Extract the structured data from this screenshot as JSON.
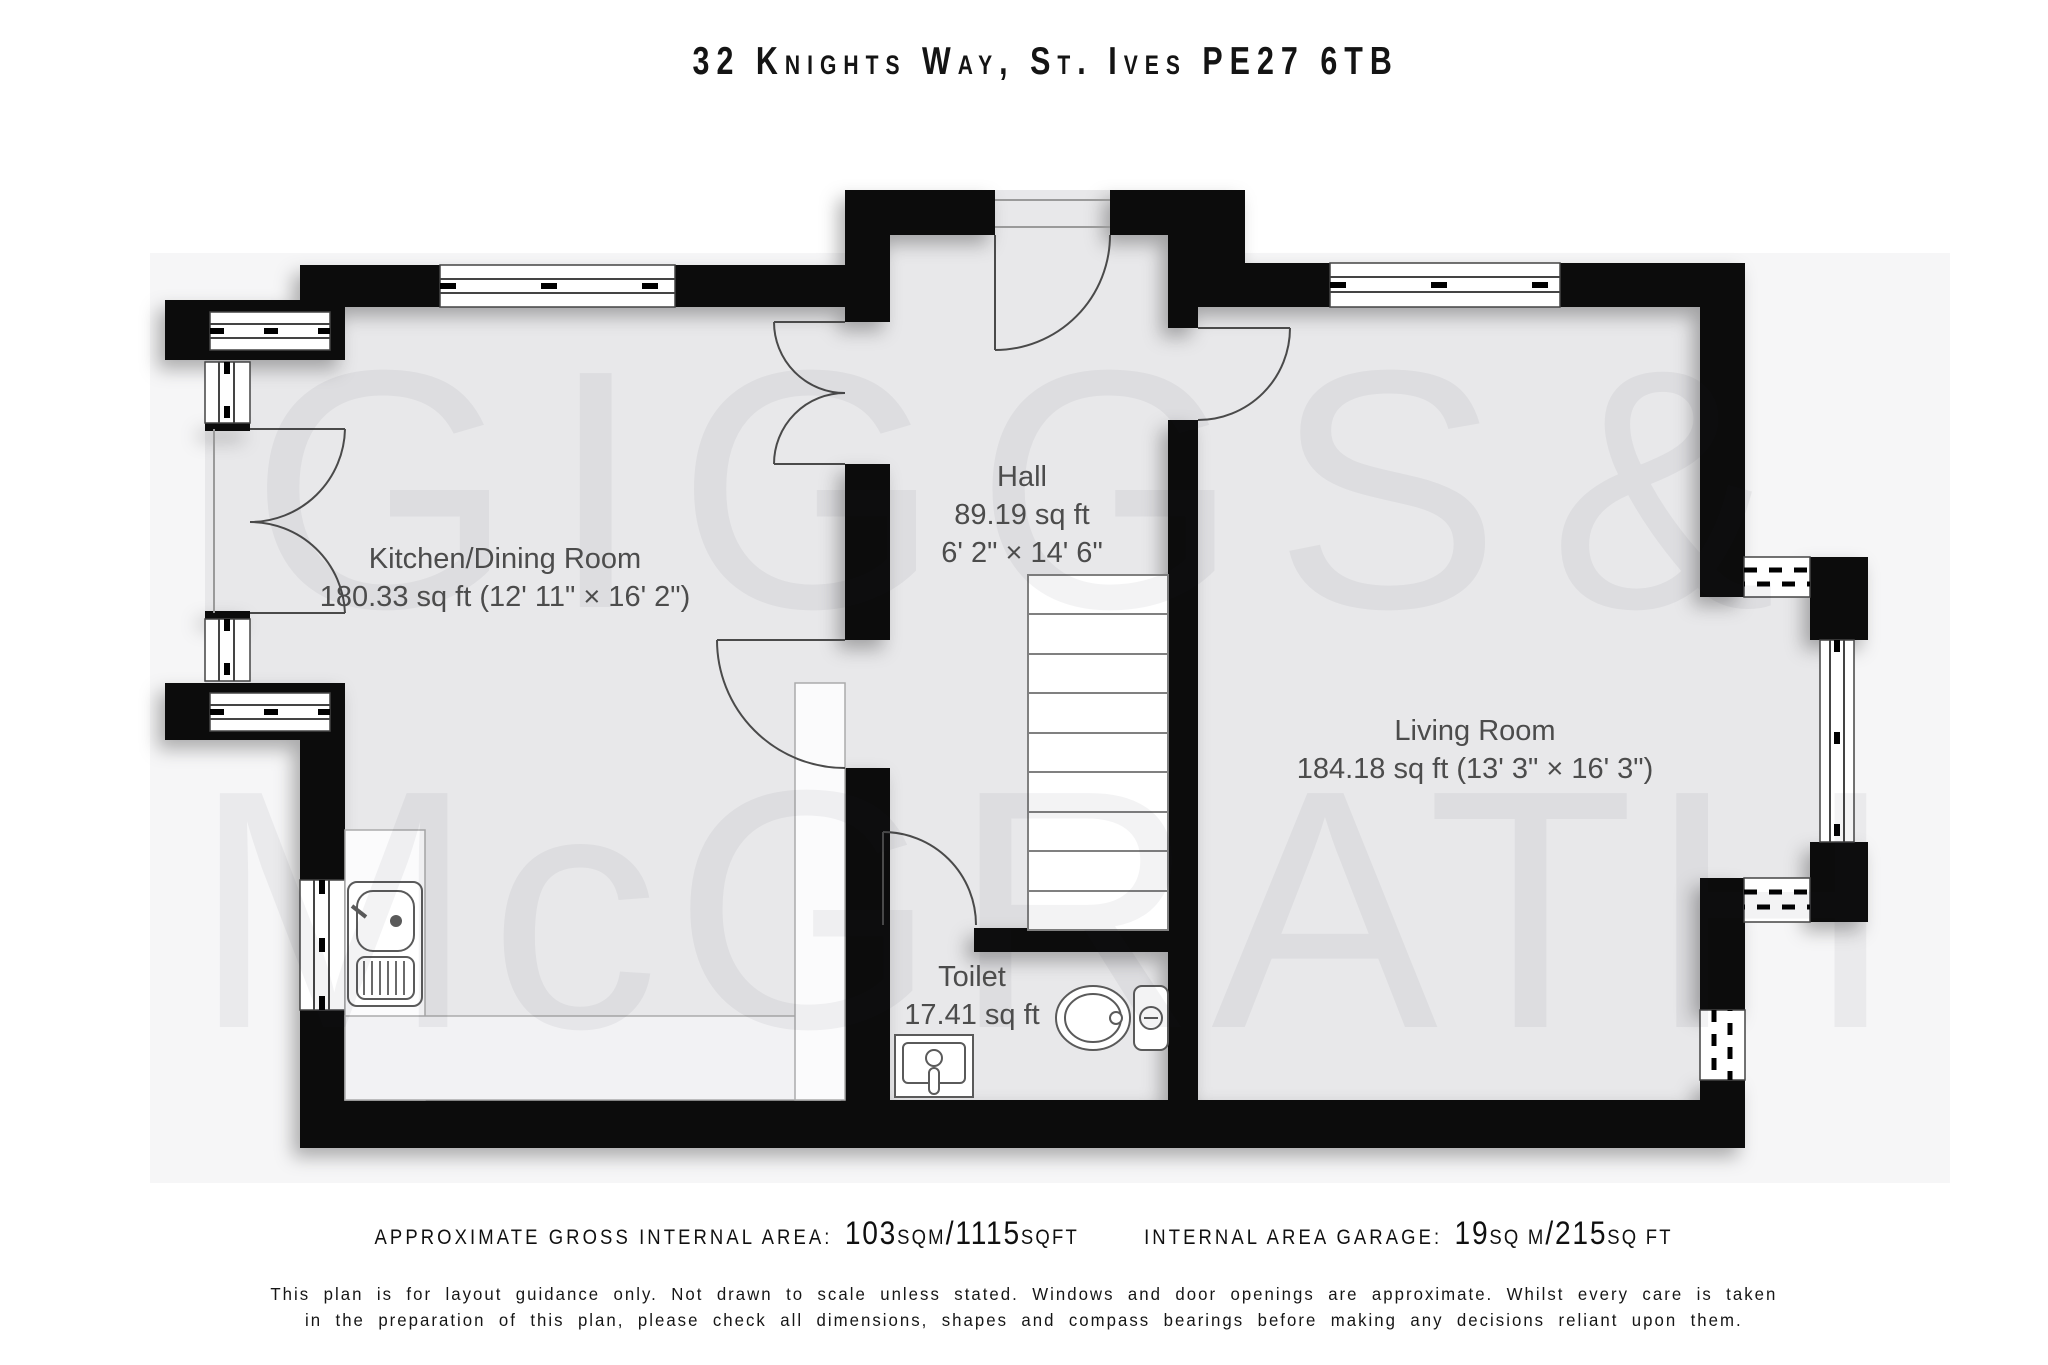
{
  "title": "32 Knights Way, St. Ives PE27 6TB",
  "watermark": {
    "word1": "GIGGS",
    "amp": "&",
    "word2": "McGRATH"
  },
  "rooms": {
    "kitchen": {
      "name": "Kitchen/Dining Room",
      "dims": "180.33 sq ft (12' 11\" × 16' 2\")"
    },
    "hall": {
      "name": "Hall",
      "area": "89.19 sq ft",
      "dims": "6' 2\" × 14' 6\""
    },
    "living": {
      "name": "Living Room",
      "dims": "184.18 sq ft (13' 3\" × 16' 3\")"
    },
    "toilet": {
      "name": "Toilet",
      "area": "17.41 sq ft"
    }
  },
  "footer": {
    "internal": {
      "label": "APPROXIMATE GROSS INTERNAL AREA:",
      "value1": "103",
      "unit1": "SQM",
      "slash": "/",
      "value2": "1115",
      "unit2": "SQFT"
    },
    "garage": {
      "label": "INTERNAL AREA GARAGE:",
      "value1": "19",
      "unit1": "SQ M",
      "slash": "/",
      "value2": "215",
      "unit2": "SQ FT"
    },
    "disclaimer_line1": "This plan is for layout guidance only. Not drawn to scale unless stated. Windows and door openings are approximate. Whilst every care is taken",
    "disclaimer_line2": "in the preparation of this plan, please check all dimensions, shapes and compass bearings before making any decisions reliant upon them."
  },
  "colors": {
    "wall": "#0c0c0c",
    "floor": "#e8e8ea",
    "page_band": "#f6f6f7",
    "counter": "#fbfbfc",
    "label_text": "#4c4c4c",
    "line": "#4a4a4a"
  }
}
